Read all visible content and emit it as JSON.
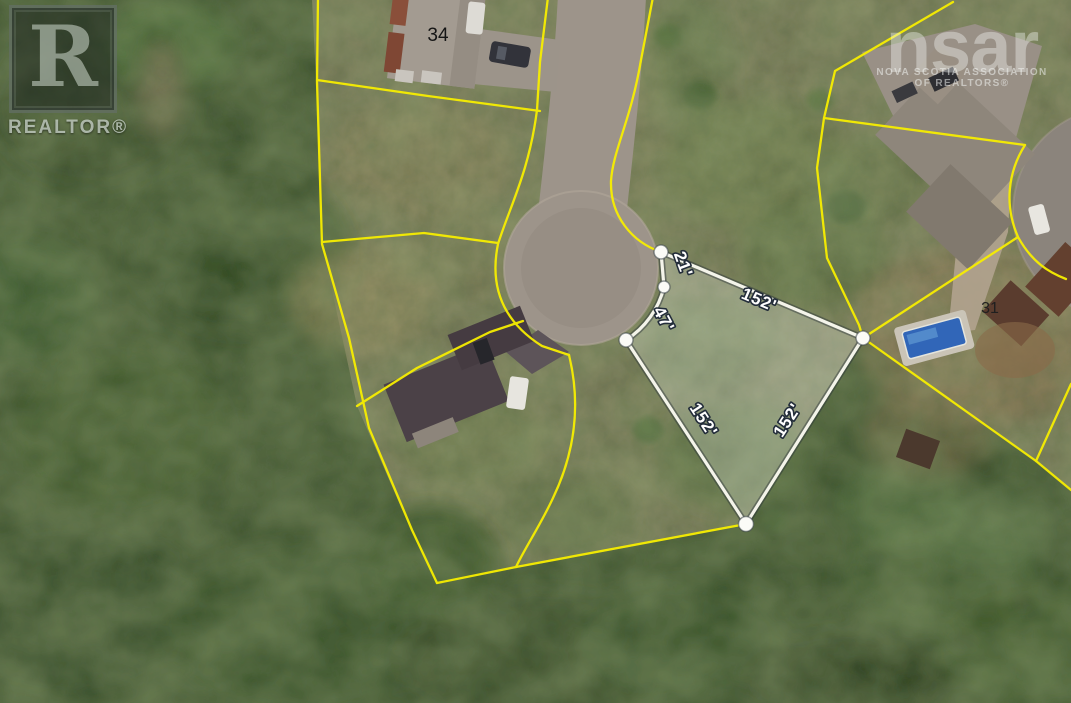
{
  "branding": {
    "realtor": {
      "letter": "R",
      "label": "REALTOR®"
    },
    "nsar": {
      "name": "nsar",
      "line1": "NOVA SCOTIA ASSOCIATION",
      "line2": "OF REALTORS®"
    }
  },
  "parcel": {
    "dimensions": {
      "frontage": "21'",
      "arc": "47'",
      "northeast": "152'",
      "southwest": "152'",
      "southeast": "152'"
    }
  },
  "neighbor_lots": {
    "north_lot": "34",
    "east_lot": "31"
  },
  "colors": {
    "boundary_line_yellow": "#f7ee00",
    "parcel_line_white": "#f4f4ea",
    "parcel_fill": "rgba(238,242,232,0.27)",
    "dim_label_fill": "#ffffff",
    "dim_label_outline": "#232d3a",
    "road_pavement": "#9d948a",
    "forest_green": "#2e4721"
  }
}
